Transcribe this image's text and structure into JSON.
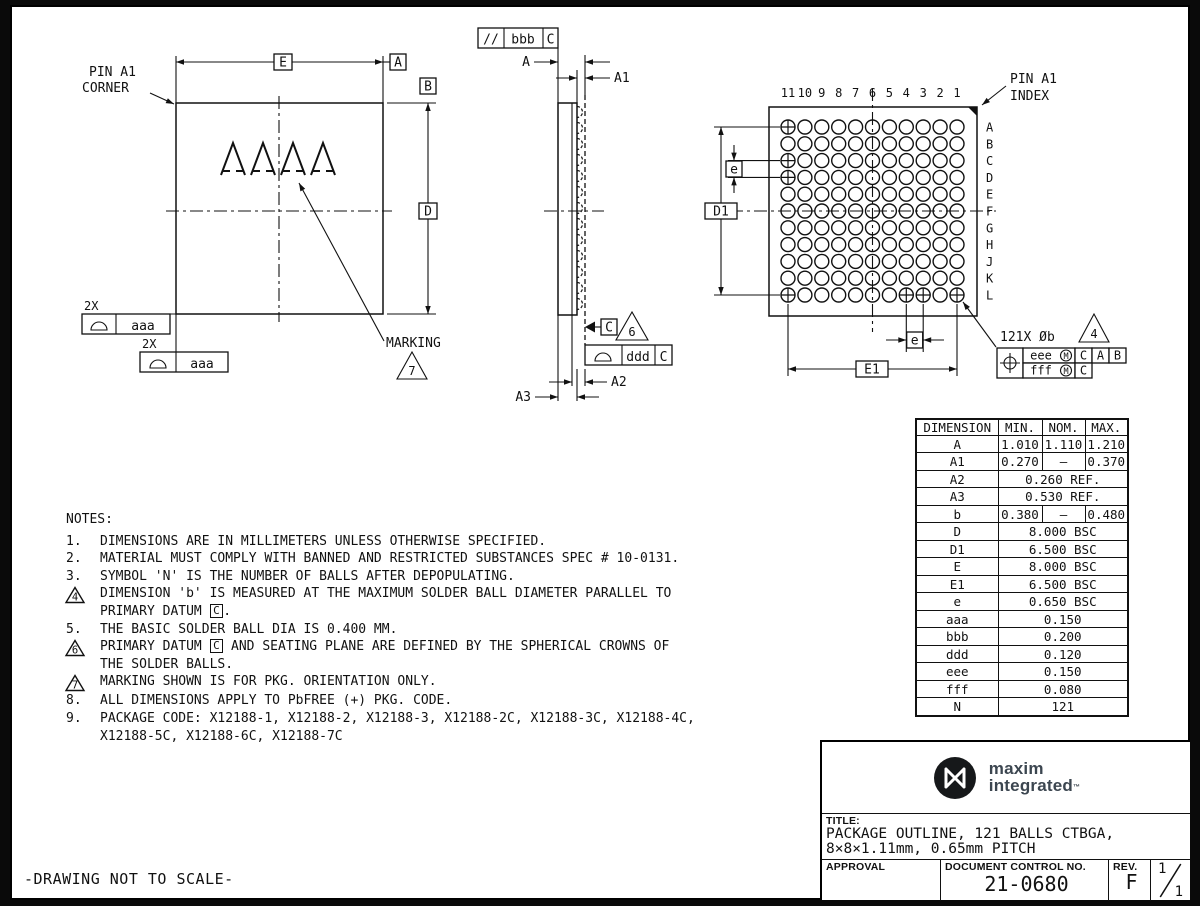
{
  "colors": {
    "line": "#111111",
    "paper": "#ffffff",
    "frame_bg": "#000000",
    "brand_text": "#3c4650",
    "brand_mark": "#16181a"
  },
  "page": {
    "footer_note": "-DRAWING NOT TO SCALE-"
  },
  "datums": {
    "a": "A",
    "b": "B",
    "c": "C"
  },
  "dims": {
    "e_basic": "E",
    "d_basic": "D",
    "d1": "D1",
    "e1": "E1",
    "e_pitch": "e",
    "a": "A",
    "a1": "A1",
    "a2": "A2",
    "a3": "A3",
    "aaa": "aaa",
    "bbb": "bbb",
    "ddd": "ddd",
    "eee": "eee",
    "fff": "fff",
    "m_modifier": "M"
  },
  "plan_view": {
    "pin_a1_corner_line1": "PIN A1",
    "pin_a1_corner_line2": "CORNER",
    "marking_label": "MARKING",
    "marking_chars": [
      "A",
      "A",
      "A",
      "A"
    ],
    "note7": "7",
    "qty_label": "2X"
  },
  "side_view": {
    "parallelism_symbol": "//",
    "note6": "6"
  },
  "bottom_view": {
    "pin_a1_index_line1": "PIN A1",
    "pin_a1_index_line2": "INDEX",
    "balls_callout": "121X Øb",
    "note4": "4",
    "columns": [
      "11",
      "10",
      "9",
      "8",
      "7",
      "6",
      "5",
      "4",
      "3",
      "2",
      "1"
    ],
    "rows": [
      "A",
      "B",
      "C",
      "D",
      "E",
      "F",
      "G",
      "H",
      "J",
      "K",
      "L"
    ],
    "cross_balls": [
      "A11",
      "C11",
      "D11",
      "L11",
      "L4",
      "L3",
      "L1"
    ]
  },
  "dim_table": {
    "headers": [
      "DIMENSION",
      "MIN.",
      "NOM.",
      "MAX."
    ],
    "rows": [
      {
        "dim": "A",
        "min": "1.010",
        "nom": "1.110",
        "max": "1.210"
      },
      {
        "dim": "A1",
        "min": "0.270",
        "nom": "–",
        "max": "0.370"
      },
      {
        "dim": "A2",
        "span": "0.260 REF."
      },
      {
        "dim": "A3",
        "span": "0.530 REF."
      },
      {
        "dim": "b",
        "min": "0.380",
        "nom": "–",
        "max": "0.480"
      },
      {
        "dim": "D",
        "span": "8.000 BSC"
      },
      {
        "dim": "D1",
        "span": "6.500 BSC"
      },
      {
        "dim": "E",
        "span": "8.000 BSC"
      },
      {
        "dim": "E1",
        "span": "6.500 BSC"
      },
      {
        "dim": "e",
        "span": "0.650 BSC"
      },
      {
        "dim": "aaa",
        "span": "0.150"
      },
      {
        "dim": "bbb",
        "span": "0.200"
      },
      {
        "dim": "ddd",
        "span": "0.120"
      },
      {
        "dim": "eee",
        "span": "0.150"
      },
      {
        "dim": "fff",
        "span": "0.080"
      },
      {
        "dim": "N",
        "span": "121"
      }
    ]
  },
  "notes": {
    "heading": "NOTES:",
    "items": [
      {
        "marker": "1.",
        "tri": false,
        "lines": [
          [
            {
              "t": "DIMENSIONS ARE IN MILLIMETERS UNLESS OTHERWISE SPECIFIED."
            }
          ]
        ]
      },
      {
        "marker": "2.",
        "tri": false,
        "lines": [
          [
            {
              "t": "MATERIAL MUST COMPLY WITH BANNED AND RESTRICTED SUBSTANCES SPEC # 10-0131."
            }
          ]
        ]
      },
      {
        "marker": "3.",
        "tri": false,
        "lines": [
          [
            {
              "t": "SYMBOL 'N' IS THE NUMBER OF BALLS AFTER DEPOPULATING."
            }
          ]
        ]
      },
      {
        "marker": "4",
        "tri": true,
        "lines": [
          [
            {
              "t": "DIMENSION 'b' IS MEASURED AT THE MAXIMUM SOLDER BALL DIAMETER PARALLEL TO"
            }
          ],
          [
            {
              "t": "PRIMARY DATUM "
            },
            {
              "b": "C"
            },
            {
              "t": "."
            }
          ]
        ]
      },
      {
        "marker": "5.",
        "tri": false,
        "lines": [
          [
            {
              "t": "THE BASIC SOLDER BALL DIA IS 0.400 MM."
            }
          ]
        ]
      },
      {
        "marker": "6",
        "tri": true,
        "lines": [
          [
            {
              "t": "PRIMARY DATUM "
            },
            {
              "b": "C"
            },
            {
              "t": " AND SEATING PLANE ARE DEFINED BY THE SPHERICAL CROWNS OF"
            }
          ],
          [
            {
              "t": "THE SOLDER BALLS."
            }
          ]
        ]
      },
      {
        "marker": "7",
        "tri": true,
        "lines": [
          [
            {
              "t": "MARKING SHOWN IS FOR PKG. ORIENTATION ONLY."
            }
          ]
        ]
      },
      {
        "marker": "8.",
        "tri": false,
        "lines": [
          [
            {
              "t": "ALL DIMENSIONS APPLY TO PbFREE (+) PKG. CODE."
            }
          ]
        ]
      },
      {
        "marker": "9.",
        "tri": false,
        "lines": [
          [
            {
              "t": "PACKAGE CODE: X12188-1, X12188-2, X12188-3, X12188-2C, X12188-3C, X12188-4C,"
            }
          ],
          [
            {
              "t": "X12188-5C, X12188-6C, X12188-7C"
            }
          ]
        ]
      }
    ]
  },
  "title_block": {
    "brand_line1": "maxim",
    "brand_line2": "integrated",
    "brand_tm": "™",
    "title_label": "TITLE:",
    "title_line1": "PACKAGE OUTLINE, 121 BALLS CTBGA,",
    "title_line2": "8×8×1.11mm, 0.65mm PITCH",
    "approval_label": "APPROVAL",
    "doc_label": "DOCUMENT CONTROL NO.",
    "doc_number": "21-0680",
    "rev_label": "REV.",
    "rev_value": "F",
    "sheet_top": "1",
    "sheet_bottom": "1"
  }
}
